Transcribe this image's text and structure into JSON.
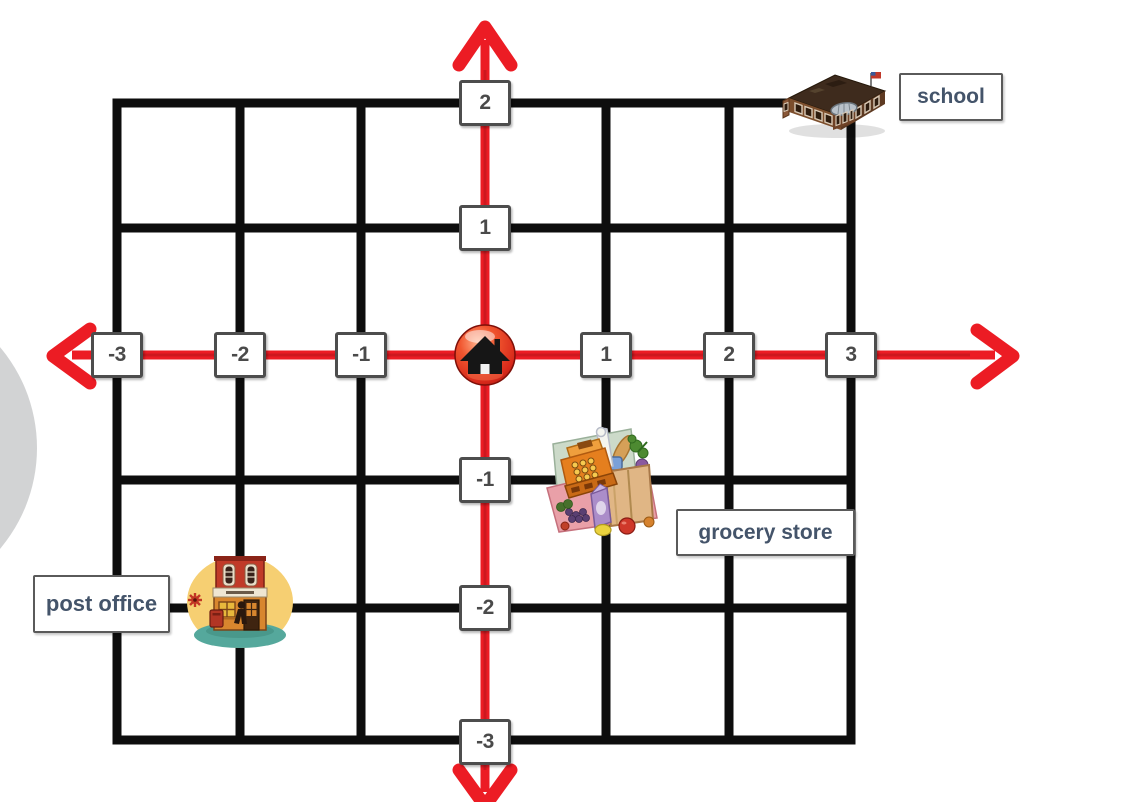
{
  "figure": {
    "type": "coordinate-grid-map",
    "background": "#ffffff",
    "grid_color": "#0d0d0d",
    "axis_color": "#ec1c24",
    "tick_box_border": "#4d4d4d",
    "tick_box_bg": "#ffffff"
  },
  "grid": {
    "x_ticks": [
      "-3",
      "-2",
      "-1",
      "1",
      "2",
      "3"
    ],
    "y_ticks": [
      "2",
      "1",
      "-1",
      "-2",
      "-3"
    ],
    "x_range": [
      -3,
      3
    ],
    "y_range": [
      -3,
      2
    ]
  },
  "places": {
    "home": {
      "x": 0,
      "y": 0,
      "icon": "home-icon"
    },
    "school": {
      "label": "school",
      "x": 3,
      "y": 2,
      "icon": "school-building-icon"
    },
    "grocery_store": {
      "label": "grocery store",
      "x": 1,
      "y": -1,
      "icon": "grocery-store-icon"
    },
    "post_office": {
      "label": "post office",
      "x": -2,
      "y": -2,
      "icon": "post-office-building-icon"
    }
  }
}
